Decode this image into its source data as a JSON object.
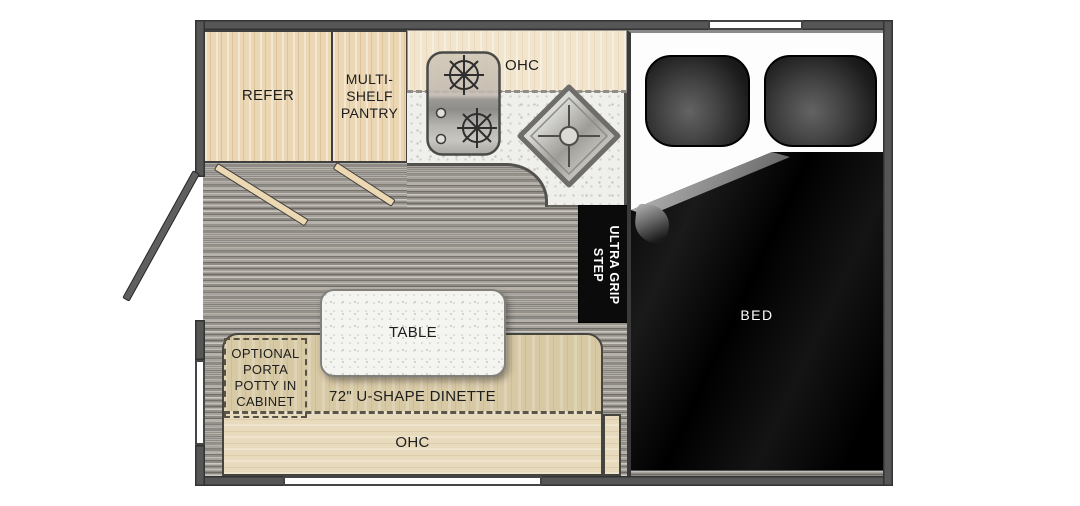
{
  "title": "truck camper floor plan",
  "colors": {
    "wall": "#565656",
    "cabinet_wood": "#ecd7b4",
    "overhead_cream": "#f2e5cd",
    "floor_gray": "#a09d97",
    "countertop": "#efefeb",
    "dinette_tan": "#d8c9a5",
    "dinette_lower_tan": "#e8dabc",
    "table_white": "#f4f4f1",
    "step_black": "#0b0b0b",
    "bed_blanket_black": "#0a0a0a",
    "label_dark": "#1d1d1d",
    "label_light": "#ffffff"
  },
  "areas": {
    "refer": {
      "label": "REFER"
    },
    "pantry": {
      "label": "MULTI-SHELF PANTRY"
    },
    "kitchen": {
      "ohc_label": "OHC"
    },
    "dinette": {
      "label": "72\" U-SHAPE DINETTE",
      "ohc_label": "OHC",
      "table_label": "TABLE",
      "porta_potty_label": "OPTIONAL PORTA POTTY IN CABINET"
    },
    "step": {
      "label": "ULTRA GRIP STEP"
    },
    "bed": {
      "label": "BED"
    }
  }
}
